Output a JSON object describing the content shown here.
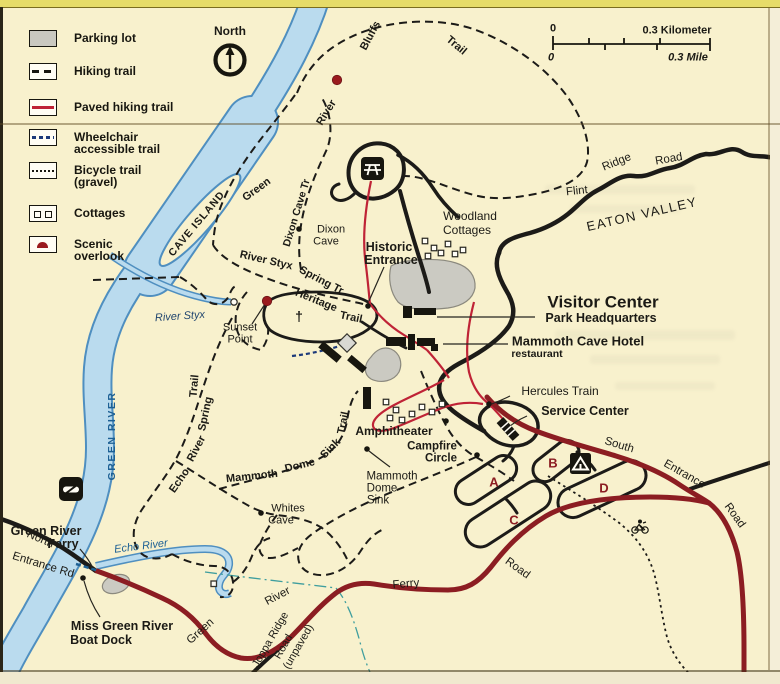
{
  "colors": {
    "background": "#f8f1cd",
    "water_fill": "#badbee",
    "water_edge": "#4f8fc0",
    "road_paved": "#8c1d22",
    "paved_trail": "#bf2336",
    "road_black": "#1c1b18",
    "parking_gray": "#cbcac2",
    "wheelchair_navy": "#1d3a7a",
    "stream_teal": "#3f9e9e",
    "campground_letter": "#8c1d22"
  },
  "legend": {
    "items": [
      {
        "id": "parking",
        "label1": "Parking lot"
      },
      {
        "id": "hiking",
        "label1": "Hiking trail"
      },
      {
        "id": "paved",
        "label1": "Paved hiking trail"
      },
      {
        "id": "wheelchair",
        "label1": "Wheelchair",
        "label2": "accessible trail"
      },
      {
        "id": "bicycle",
        "label1": "Bicycle trail",
        "label2": "(gravel)"
      },
      {
        "id": "cottages",
        "label1": "Cottages"
      },
      {
        "id": "scenic",
        "label1": "Scenic",
        "label2": "overlook"
      }
    ]
  },
  "compass": {
    "label": "North"
  },
  "scalebar": {
    "zero_km": "0",
    "km_label": "0.3 Kilometer",
    "zero_mi": "0",
    "mi_label": "0.3 Mile"
  },
  "map": {
    "labels": [
      {
        "id": "cave-island",
        "text": "CAVE ISLAND",
        "x": 197,
        "y": 224,
        "rot": -50,
        "size": 10.5,
        "weight": 600,
        "spacing": 1
      },
      {
        "id": "grb-green",
        "text": "Green",
        "x": 257,
        "y": 190,
        "rot": -36,
        "size": 11,
        "weight": 600
      },
      {
        "id": "grb-river",
        "text": "River",
        "x": 327,
        "y": 113,
        "rot": -58,
        "size": 11,
        "weight": 600
      },
      {
        "id": "grb-bluffs",
        "text": "Bluffs",
        "x": 371,
        "y": 36,
        "rot": -62,
        "size": 11,
        "weight": 600
      },
      {
        "id": "grb-trail",
        "text": "Trail",
        "x": 456,
        "y": 46,
        "rot": 40,
        "size": 11,
        "weight": 600
      },
      {
        "id": "dixon-cave-tr",
        "text": "Dixon Cave Tr",
        "x": 297,
        "y": 213,
        "rot": -73,
        "size": 10.5,
        "weight": 600
      },
      {
        "id": "dixon-cave-1",
        "text": "Dixon",
        "x": 331,
        "y": 230,
        "size": 11
      },
      {
        "id": "dixon-cave-2",
        "text": "Cave",
        "x": 326,
        "y": 242,
        "size": 11
      },
      {
        "id": "styx-spring-tr-1",
        "text": "River Styx",
        "x": 266,
        "y": 261,
        "rot": 13,
        "size": 11,
        "weight": 600
      },
      {
        "id": "styx-spring-tr-2",
        "text": "Spring Tr",
        "x": 321,
        "y": 281,
        "rot": 28,
        "size": 11,
        "weight": 600
      },
      {
        "id": "heritage-1",
        "text": "Heritage",
        "x": 316,
        "y": 301,
        "rot": 22,
        "size": 11,
        "weight": 600
      },
      {
        "id": "heritage-2",
        "text": "Trail",
        "x": 351,
        "y": 318,
        "rot": 12,
        "size": 11,
        "weight": 600
      },
      {
        "id": "river-styx",
        "text": "River Styx",
        "x": 180,
        "y": 317,
        "rot": -4,
        "size": 11,
        "italic": true,
        "color": "#20456e"
      },
      {
        "id": "sunset-point-1",
        "text": "Sunset",
        "x": 240,
        "y": 328,
        "size": 11
      },
      {
        "id": "sunset-point-2",
        "text": "Point",
        "x": 240,
        "y": 340,
        "size": 11
      },
      {
        "id": "historic-1",
        "text": "Historic",
        "x": 389,
        "y": 247,
        "size": 12.5,
        "weight": 700
      },
      {
        "id": "historic-2",
        "text": "Entrance",
        "x": 391,
        "y": 260,
        "size": 12.5,
        "weight": 700
      },
      {
        "id": "woodland-1",
        "text": "Woodland",
        "x": 470,
        "y": 216,
        "size": 12
      },
      {
        "id": "woodland-2",
        "text": "Cottages",
        "x": 467,
        "y": 230,
        "size": 12
      },
      {
        "id": "flint",
        "text": "Flint",
        "x": 577,
        "y": 192,
        "rot": -6,
        "size": 11.5
      },
      {
        "id": "ridge",
        "text": "Ridge",
        "x": 617,
        "y": 163,
        "rot": -22,
        "size": 11.5
      },
      {
        "id": "road-flint",
        "text": "Road",
        "x": 669,
        "y": 160,
        "rot": -10,
        "size": 11.5
      },
      {
        "id": "eaton-valley",
        "text": "EATON VALLEY",
        "x": 642,
        "y": 214,
        "rot": -13,
        "size": 13,
        "spacing": 1.5
      },
      {
        "id": "visitor-center",
        "text": "Visitor Center",
        "x": 603,
        "y": 302,
        "size": 17,
        "weight": 700
      },
      {
        "id": "park-headquarters",
        "text": "Park Headquarters",
        "x": 601,
        "y": 318,
        "size": 12.5,
        "weight": 700
      },
      {
        "id": "mammoth-cave-hotel",
        "text": "Mammoth Cave Hotel",
        "x": 578,
        "y": 341,
        "size": 13,
        "weight": 700
      },
      {
        "id": "restaurant",
        "text": "restaurant",
        "x": 537,
        "y": 354,
        "size": 10.5,
        "weight": 700
      },
      {
        "id": "hercules-train",
        "text": "Hercules Train",
        "x": 560,
        "y": 391,
        "size": 12
      },
      {
        "id": "service-center",
        "text": "Service Center",
        "x": 585,
        "y": 411,
        "size": 12.5,
        "weight": 700
      },
      {
        "id": "amphitheater",
        "text": "Amphitheater",
        "x": 394,
        "y": 431,
        "size": 12,
        "weight": 700
      },
      {
        "id": "campfire-1",
        "text": "Campfire",
        "x": 432,
        "y": 447,
        "size": 11.5,
        "weight": 700
      },
      {
        "id": "campfire-2",
        "text": "Circle",
        "x": 441,
        "y": 459,
        "size": 11.5,
        "weight": 700
      },
      {
        "id": "mds-1",
        "text": "Mammoth",
        "x": 392,
        "y": 477,
        "size": 11.5
      },
      {
        "id": "mds-2",
        "text": "Dome",
        "x": 382,
        "y": 489,
        "size": 11.5
      },
      {
        "id": "mds-3",
        "text": "Sink",
        "x": 378,
        "y": 501,
        "size": 11.5
      },
      {
        "id": "mds-trail-1",
        "text": "Mammoth",
        "x": 252,
        "y": 477,
        "rot": -6,
        "size": 11,
        "weight": 600
      },
      {
        "id": "mds-trail-2",
        "text": "Dome",
        "x": 300,
        "y": 466,
        "rot": -14,
        "size": 11,
        "weight": 600
      },
      {
        "id": "mds-trail-3",
        "text": "Sink",
        "x": 331,
        "y": 449,
        "rot": -45,
        "size": 11,
        "weight": 600
      },
      {
        "id": "mds-trail-4",
        "text": "Trail",
        "x": 344,
        "y": 423,
        "rot": -78,
        "size": 11,
        "weight": 600
      },
      {
        "id": "echo-spring-1",
        "text": "Echo",
        "x": 180,
        "y": 481,
        "rot": -55,
        "size": 11,
        "weight": 600
      },
      {
        "id": "echo-spring-2",
        "text": "River",
        "x": 197,
        "y": 449,
        "rot": -62,
        "size": 11,
        "weight": 600
      },
      {
        "id": "echo-spring-3",
        "text": "Spring",
        "x": 206,
        "y": 414,
        "rot": -78,
        "size": 11,
        "weight": 600
      },
      {
        "id": "echo-spring-4",
        "text": "Trail",
        "x": 195,
        "y": 386,
        "rot": -85,
        "size": 11,
        "weight": 600
      },
      {
        "id": "whites-cave-1",
        "text": "Whites",
        "x": 288,
        "y": 509,
        "size": 11
      },
      {
        "id": "whites-cave-2",
        "text": "Cave",
        "x": 281,
        "y": 521,
        "size": 11
      },
      {
        "id": "green-river-vert",
        "text": "GREEN RIVER",
        "x": 112,
        "y": 436,
        "rot": -90,
        "size": 10.5,
        "weight": 700,
        "color": "#1d6094",
        "spacing": 1.5
      },
      {
        "id": "echo-river",
        "text": "Echo River",
        "x": 141,
        "y": 547,
        "rot": -7,
        "size": 11,
        "italic": true,
        "color": "#1d6094"
      },
      {
        "id": "green-river-ferry-1",
        "text": "Green River",
        "x": 46,
        "y": 531,
        "size": 12.5,
        "weight": 700
      },
      {
        "id": "green-river-ferry-2",
        "text": "Ferry",
        "x": 63,
        "y": 544,
        "size": 12.5,
        "weight": 700
      },
      {
        "id": "north-entrance-1",
        "text": "North",
        "x": 40,
        "y": 540,
        "rot": 23,
        "size": 11.5
      },
      {
        "id": "north-entrance-2",
        "text": "Entrance Rd",
        "x": 43,
        "y": 566,
        "rot": 17,
        "size": 11.5
      },
      {
        "id": "boat-dock-1",
        "text": "Miss Green River",
        "x": 122,
        "y": 626,
        "size": 12.5,
        "weight": 700
      },
      {
        "id": "boat-dock-2",
        "text": "Boat Dock",
        "x": 101,
        "y": 640,
        "size": 12.5,
        "weight": 700
      },
      {
        "id": "grf-road-green",
        "text": "Green",
        "x": 201,
        "y": 632,
        "rot": -42,
        "size": 11.5
      },
      {
        "id": "grf-road-river",
        "text": "River",
        "x": 278,
        "y": 597,
        "rot": -28,
        "size": 11.5
      },
      {
        "id": "grf-road-ferry",
        "text": "Ferry",
        "x": 406,
        "y": 585,
        "rot": -5,
        "size": 11.5
      },
      {
        "id": "grf-road-road",
        "text": "Road",
        "x": 517,
        "y": 569,
        "rot": 36,
        "size": 11.5
      },
      {
        "id": "joppa-1",
        "text": "Joppa Ridge",
        "x": 271,
        "y": 640,
        "rot": -60,
        "size": 11
      },
      {
        "id": "joppa-2",
        "text": "Road",
        "x": 284,
        "y": 647,
        "rot": -60,
        "size": 11
      },
      {
        "id": "joppa-3",
        "text": "(unpaved)",
        "x": 299,
        "y": 647,
        "rot": -60,
        "size": 11
      },
      {
        "id": "south",
        "text": "South",
        "x": 619,
        "y": 446,
        "rot": 17,
        "size": 11.5
      },
      {
        "id": "entrance",
        "text": "Entrance",
        "x": 684,
        "y": 475,
        "rot": 30,
        "size": 11.5
      },
      {
        "id": "road-south",
        "text": "Road",
        "x": 734,
        "y": 516,
        "rot": 54,
        "size": 11.5
      },
      {
        "id": "camp-a",
        "text": "A",
        "x": 494,
        "y": 482,
        "size": 13,
        "weight": 700,
        "color": "#8c1d22"
      },
      {
        "id": "camp-b",
        "text": "B",
        "x": 553,
        "y": 463,
        "size": 13,
        "weight": 700,
        "color": "#8c1d22"
      },
      {
        "id": "camp-c",
        "text": "C",
        "x": 514,
        "y": 520,
        "size": 13,
        "weight": 700,
        "color": "#8c1d22"
      },
      {
        "id": "camp-d",
        "text": "D",
        "x": 604,
        "y": 488,
        "size": 13,
        "weight": 700,
        "color": "#8c1d22"
      },
      {
        "id": "church-cross",
        "text": "†",
        "x": 299,
        "y": 316,
        "size": 14,
        "weight": 700
      }
    ],
    "poi_dots": [
      {
        "id": "historic-entrance",
        "x": 368,
        "y": 306
      },
      {
        "id": "dixon-cave",
        "x": 299,
        "y": 229
      },
      {
        "id": "hercules-train",
        "x": 489,
        "y": 404
      },
      {
        "id": "amphitheater",
        "x": 446,
        "y": 421
      },
      {
        "id": "campfire-circle",
        "x": 477,
        "y": 455
      },
      {
        "id": "mammoth-dome-sink",
        "x": 367,
        "y": 449
      },
      {
        "id": "whites-cave",
        "x": 261,
        "y": 513
      },
      {
        "id": "boat-dock",
        "x": 83,
        "y": 578
      }
    ],
    "overlook_dots": [
      {
        "id": "bluffs-overlook",
        "x": 337,
        "y": 80
      },
      {
        "id": "sunset-point-overlook",
        "x": 267,
        "y": 301
      }
    ],
    "cottage_squares": [
      {
        "x": 425,
        "y": 241
      },
      {
        "x": 434,
        "y": 248
      },
      {
        "x": 428,
        "y": 256
      },
      {
        "x": 441,
        "y": 253
      },
      {
        "x": 448,
        "y": 244
      },
      {
        "x": 455,
        "y": 254
      },
      {
        "x": 463,
        "y": 250
      },
      {
        "x": 386,
        "y": 402
      },
      {
        "x": 396,
        "y": 410
      },
      {
        "x": 390,
        "y": 418
      },
      {
        "x": 402,
        "y": 420
      },
      {
        "x": 412,
        "y": 414
      },
      {
        "x": 422,
        "y": 407
      },
      {
        "x": 432,
        "y": 412
      },
      {
        "x": 442,
        "y": 404
      }
    ]
  }
}
